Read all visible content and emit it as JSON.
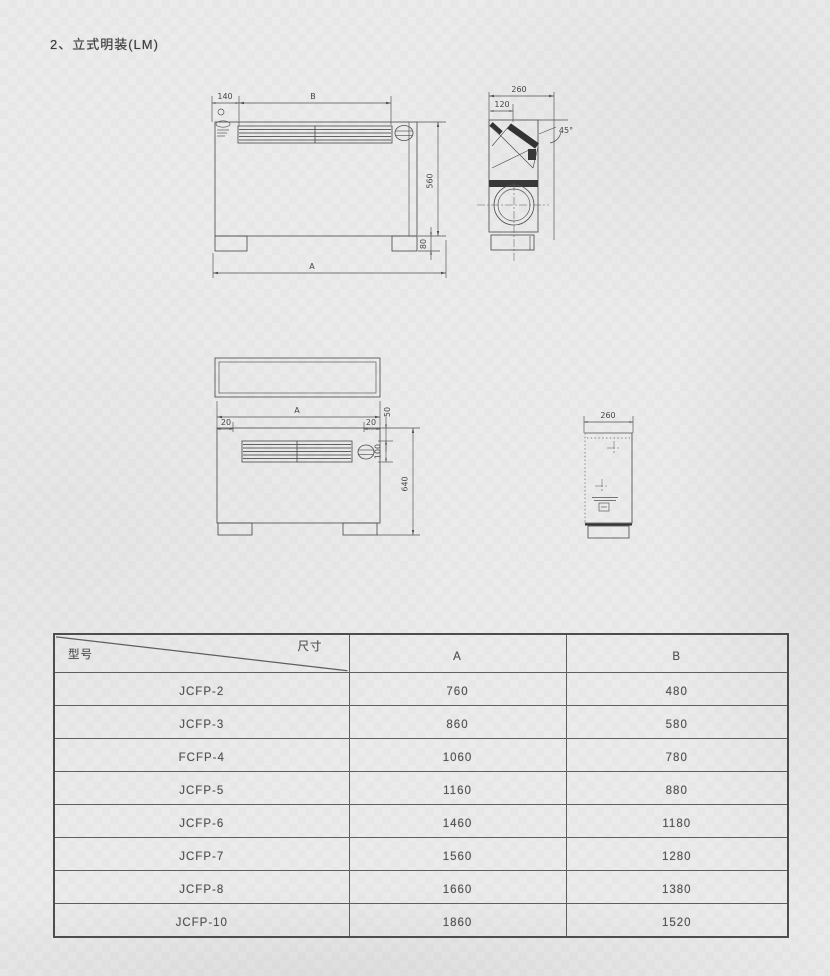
{
  "page": {
    "title": "2、立式明装(LM)"
  },
  "drawings": {
    "front_view": {
      "dim_left_offset": "140",
      "dim_grille_width": "B",
      "dim_body_height": "560",
      "dim_foot_height": "80",
      "dim_total_width": "A"
    },
    "side_view": {
      "dim_depth": "260",
      "dim_top_inset": "120",
      "dim_coil_angle": "45°"
    },
    "front_view_lower": {
      "dim_total_width": "A",
      "dim_left_inset": "20",
      "dim_right_inset": "20",
      "dim_top_offset": "50",
      "dim_grille_height": "100",
      "dim_total_height": "640"
    },
    "side_view_lower": {
      "dim_depth": "260"
    }
  },
  "table": {
    "header": {
      "model_label": "型号",
      "size_label": "尺寸",
      "col_a": "A",
      "col_b": "B"
    },
    "rows": [
      {
        "model": "JCFP-2",
        "a": "760",
        "b": "480"
      },
      {
        "model": "JCFP-3",
        "a": "860",
        "b": "580"
      },
      {
        "model": "FCFP-4",
        "a": "1060",
        "b": "780"
      },
      {
        "model": "JCFP-5",
        "a": "1160",
        "b": "880"
      },
      {
        "model": "JCFP-6",
        "a": "1460",
        "b": "1180"
      },
      {
        "model": "JCFP-7",
        "a": "1560",
        "b": "1280"
      },
      {
        "model": "JCFP-8",
        "a": "1660",
        "b": "1380"
      },
      {
        "model": "JCFP-10",
        "a": "1860",
        "b": "1520"
      }
    ]
  },
  "colors": {
    "paper": "#ebebeb",
    "line": "#4f4f4f",
    "text": "#525252"
  }
}
